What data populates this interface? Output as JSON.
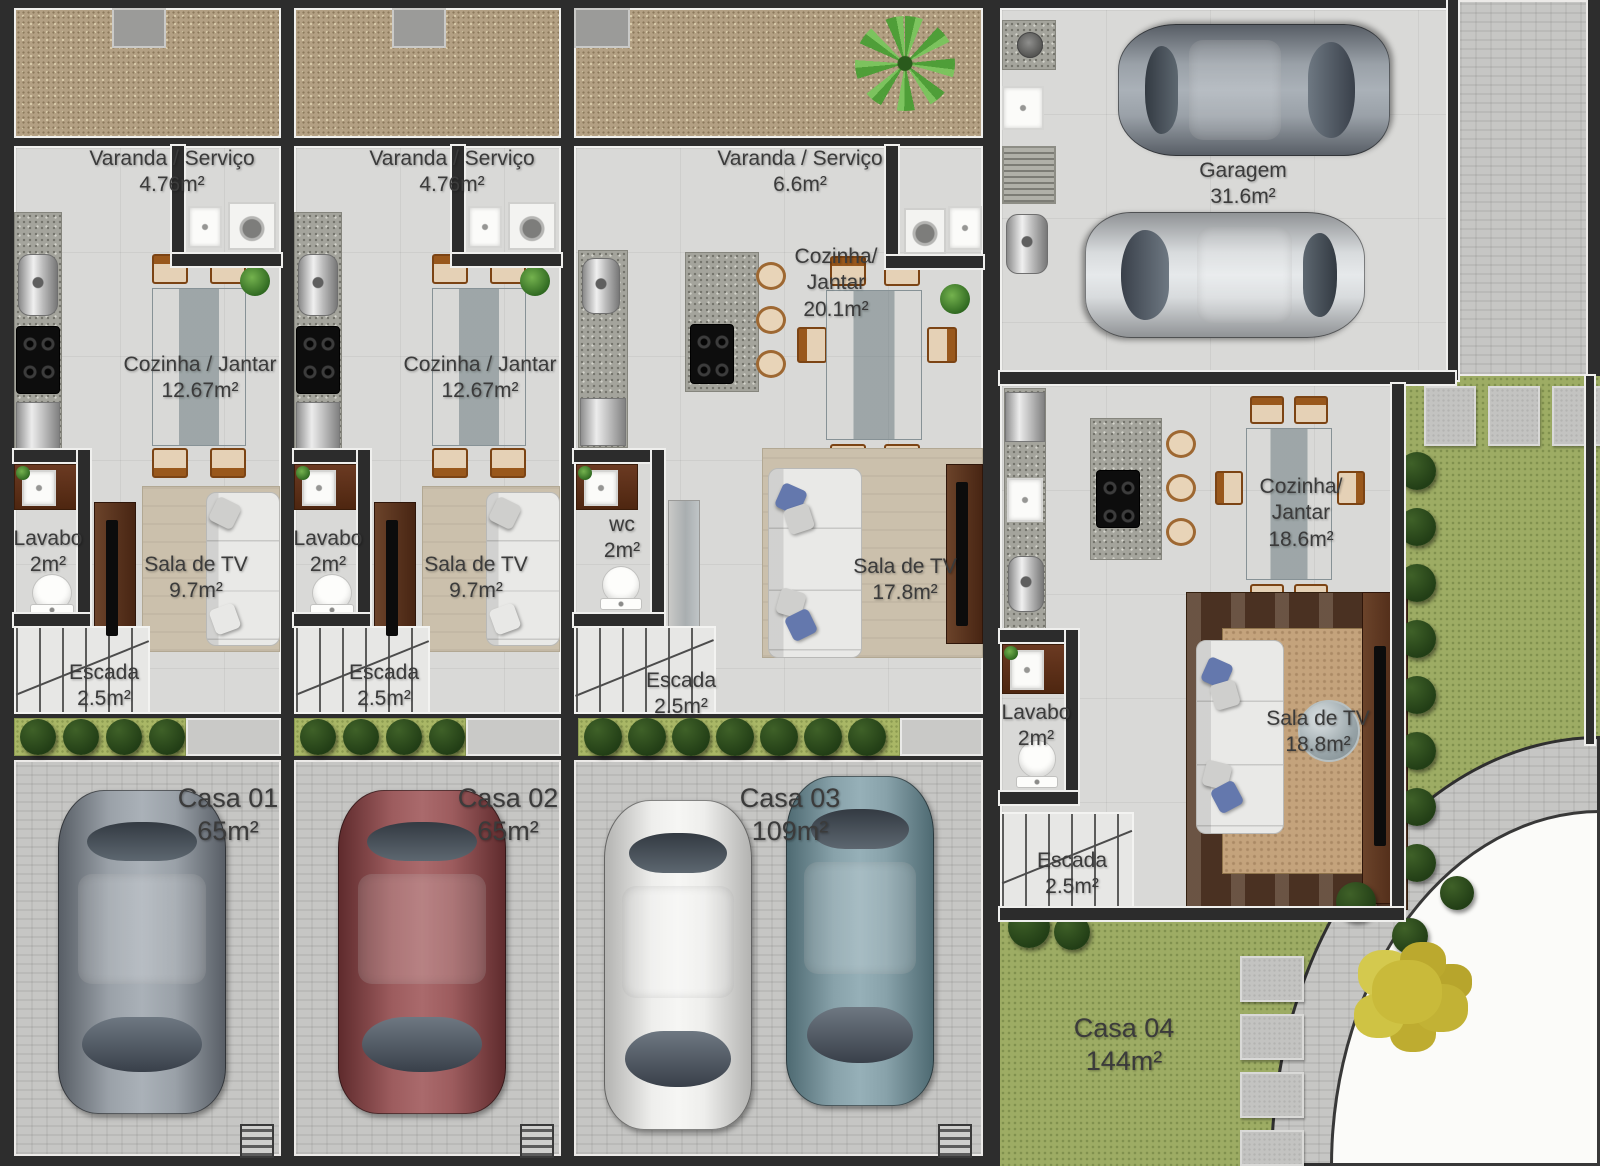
{
  "units": {
    "casa01": {
      "label": "Casa 01",
      "area": "65m²",
      "varanda": {
        "name": "Varanda / Serviço",
        "area": "4.76m²"
      },
      "cozinha": {
        "name": "Cozinha / Jantar",
        "area": "12.67m²"
      },
      "lavabo": {
        "name": "Lavabo",
        "area": "2m²"
      },
      "sala": {
        "name": "Sala de TV",
        "area": "9.7m²"
      },
      "escada": {
        "name": "Escada",
        "area": "2.5m²"
      }
    },
    "casa02": {
      "label": "Casa 02",
      "area": "65m²",
      "varanda": {
        "name": "Varanda / Serviço",
        "area": "4.76m²"
      },
      "cozinha": {
        "name": "Cozinha / Jantar",
        "area": "12.67m²"
      },
      "lavabo": {
        "name": "Lavabo",
        "area": "2m²"
      },
      "sala": {
        "name": "Sala de TV",
        "area": "9.7m²"
      },
      "escada": {
        "name": "Escada",
        "area": "2.5m²"
      }
    },
    "casa03": {
      "label": "Casa 03",
      "area": "109m²",
      "varanda": {
        "name": "Varanda / Serviço",
        "area": "6.6m²"
      },
      "cozinha": {
        "line1": "Cozinha/",
        "line2": "Jantar",
        "area": "20.1m²"
      },
      "wc": {
        "name": "wc",
        "area": "2m²"
      },
      "sala": {
        "name": "Sala de TV",
        "area": "17.8m²"
      },
      "escada": {
        "name": "Escada",
        "area": "2.5m²"
      }
    },
    "casa04": {
      "label": "Casa 04",
      "area": "144m²",
      "garagem": {
        "name": "Garagem",
        "area": "31.6m²"
      },
      "cozinha": {
        "line1": "Cozinha/",
        "line2": "Jantar",
        "area": "18.6m²"
      },
      "lavabo": {
        "name": "Lavabo",
        "area": "2m²"
      },
      "sala": {
        "name": "Sala de TV",
        "area": "18.8m²"
      },
      "escada": {
        "name": "Escada",
        "area": "2.5m²"
      }
    }
  },
  "colors": {
    "wall": "#2d2d2d",
    "floor": "#d9d9d7",
    "gravel": "#b3a083",
    "lawn": "#9dac64",
    "garden_strip": "#a9b766",
    "bush": "#2c481d",
    "paving": "#c6c6c4",
    "rug_beige": "#cbc0ac",
    "rug_brown": "#4a3122",
    "wood_panel": "#5e3120",
    "sofa": "#e9e9e7",
    "pillow_blue": "#6478ad",
    "car_gray": "#8a9098",
    "car_red": "#8e5052",
    "car_white": "#e6e6e4",
    "car_teal": "#7b97a0",
    "car_silver": "#c8cbcd"
  }
}
